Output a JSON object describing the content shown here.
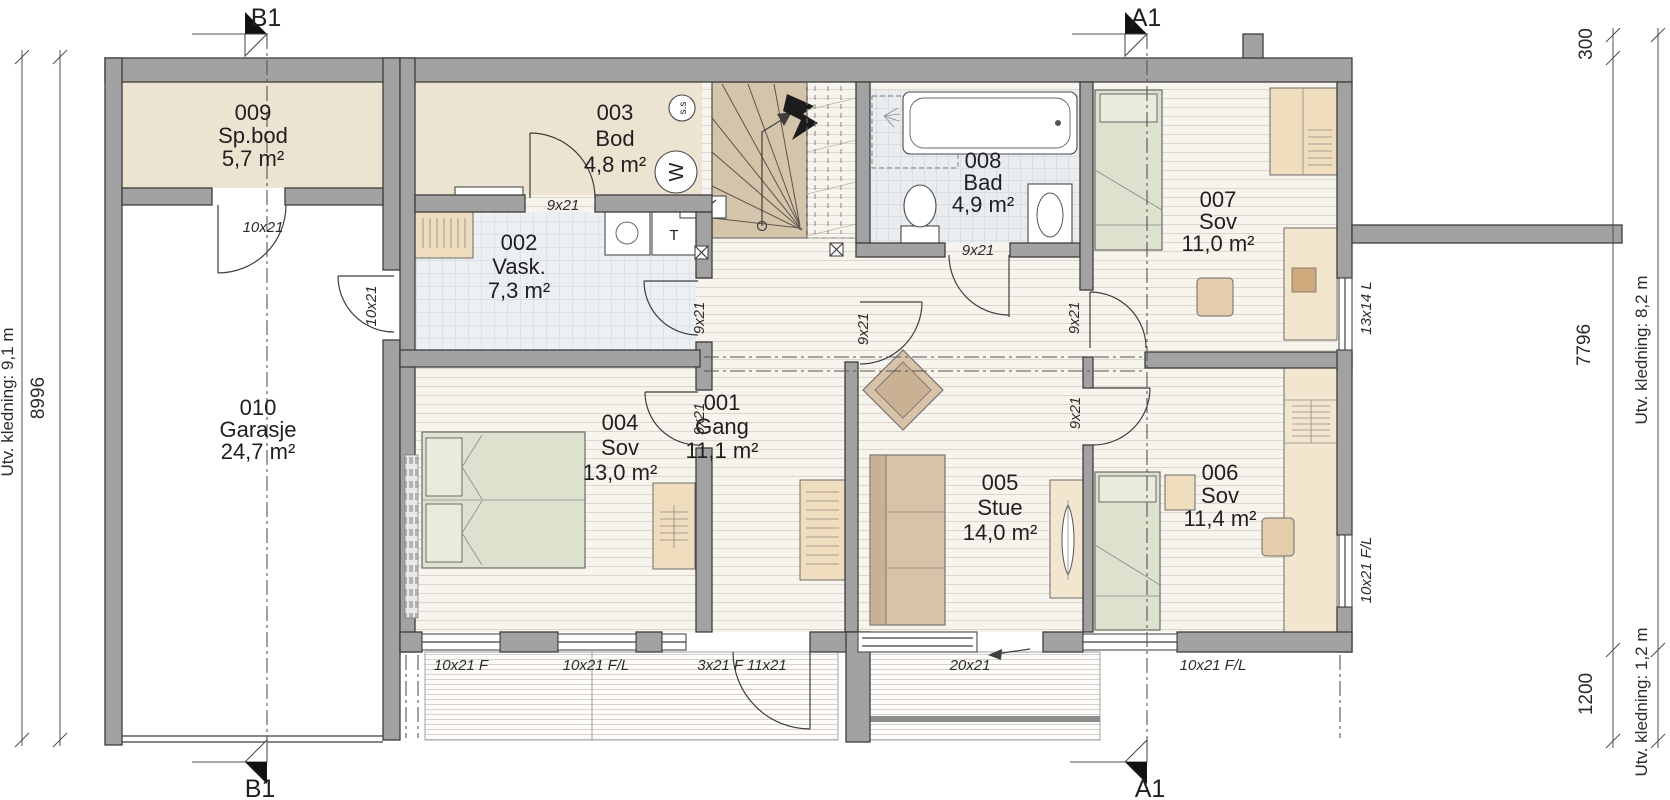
{
  "plan": {
    "rooms": [
      {
        "number": "001",
        "name": "Gang",
        "area": "11,1 m²"
      },
      {
        "number": "002",
        "name": "Vask.",
        "area": "7,3 m²"
      },
      {
        "number": "003",
        "name": "Bod",
        "area": "4,8 m²"
      },
      {
        "number": "004",
        "name": "Sov",
        "area": "13,0 m²"
      },
      {
        "number": "005",
        "name": "Stue",
        "area": "14,0 m²"
      },
      {
        "number": "006",
        "name": "Sov",
        "area": "11,4 m²"
      },
      {
        "number": "007",
        "name": "Sov",
        "area": "11,0 m²"
      },
      {
        "number": "008",
        "name": "Bad",
        "area": "4,9 m²"
      },
      {
        "number": "009",
        "name": "Sp.bod",
        "area": "5,7 m²"
      },
      {
        "number": "010",
        "name": "Garasje",
        "area": "24,7 m²"
      }
    ],
    "openings": [
      {
        "text": "10x21"
      },
      {
        "text": "10x21"
      },
      {
        "text": "9x21"
      },
      {
        "text": "9x21"
      },
      {
        "text": "9x21"
      },
      {
        "text": "9x21"
      },
      {
        "text": "9x21"
      },
      {
        "text": "9x21"
      },
      {
        "text": "9x21"
      },
      {
        "text": "10x21 F"
      },
      {
        "text": "10x21 F/L"
      },
      {
        "text": "3x21 F 11x21"
      },
      {
        "text": "20x21"
      },
      {
        "text": "10x21 F/L"
      },
      {
        "text": "13x14 L"
      },
      {
        "text": "10x21 F/L"
      }
    ],
    "dimensions": [
      {
        "text": "8996"
      },
      {
        "text": "Utv. kledning: 9,1 m"
      },
      {
        "text": "300"
      },
      {
        "text": "7796"
      },
      {
        "text": "1200"
      },
      {
        "text": "Utv. kledning: 8,2 m"
      },
      {
        "text": "Utv. kledning: 1,2 m"
      }
    ],
    "sections": {
      "b1": "B1",
      "a1": "A1"
    },
    "symbols": {
      "ss": "s.s",
      "water_heater": "W",
      "dryer": "T"
    }
  }
}
